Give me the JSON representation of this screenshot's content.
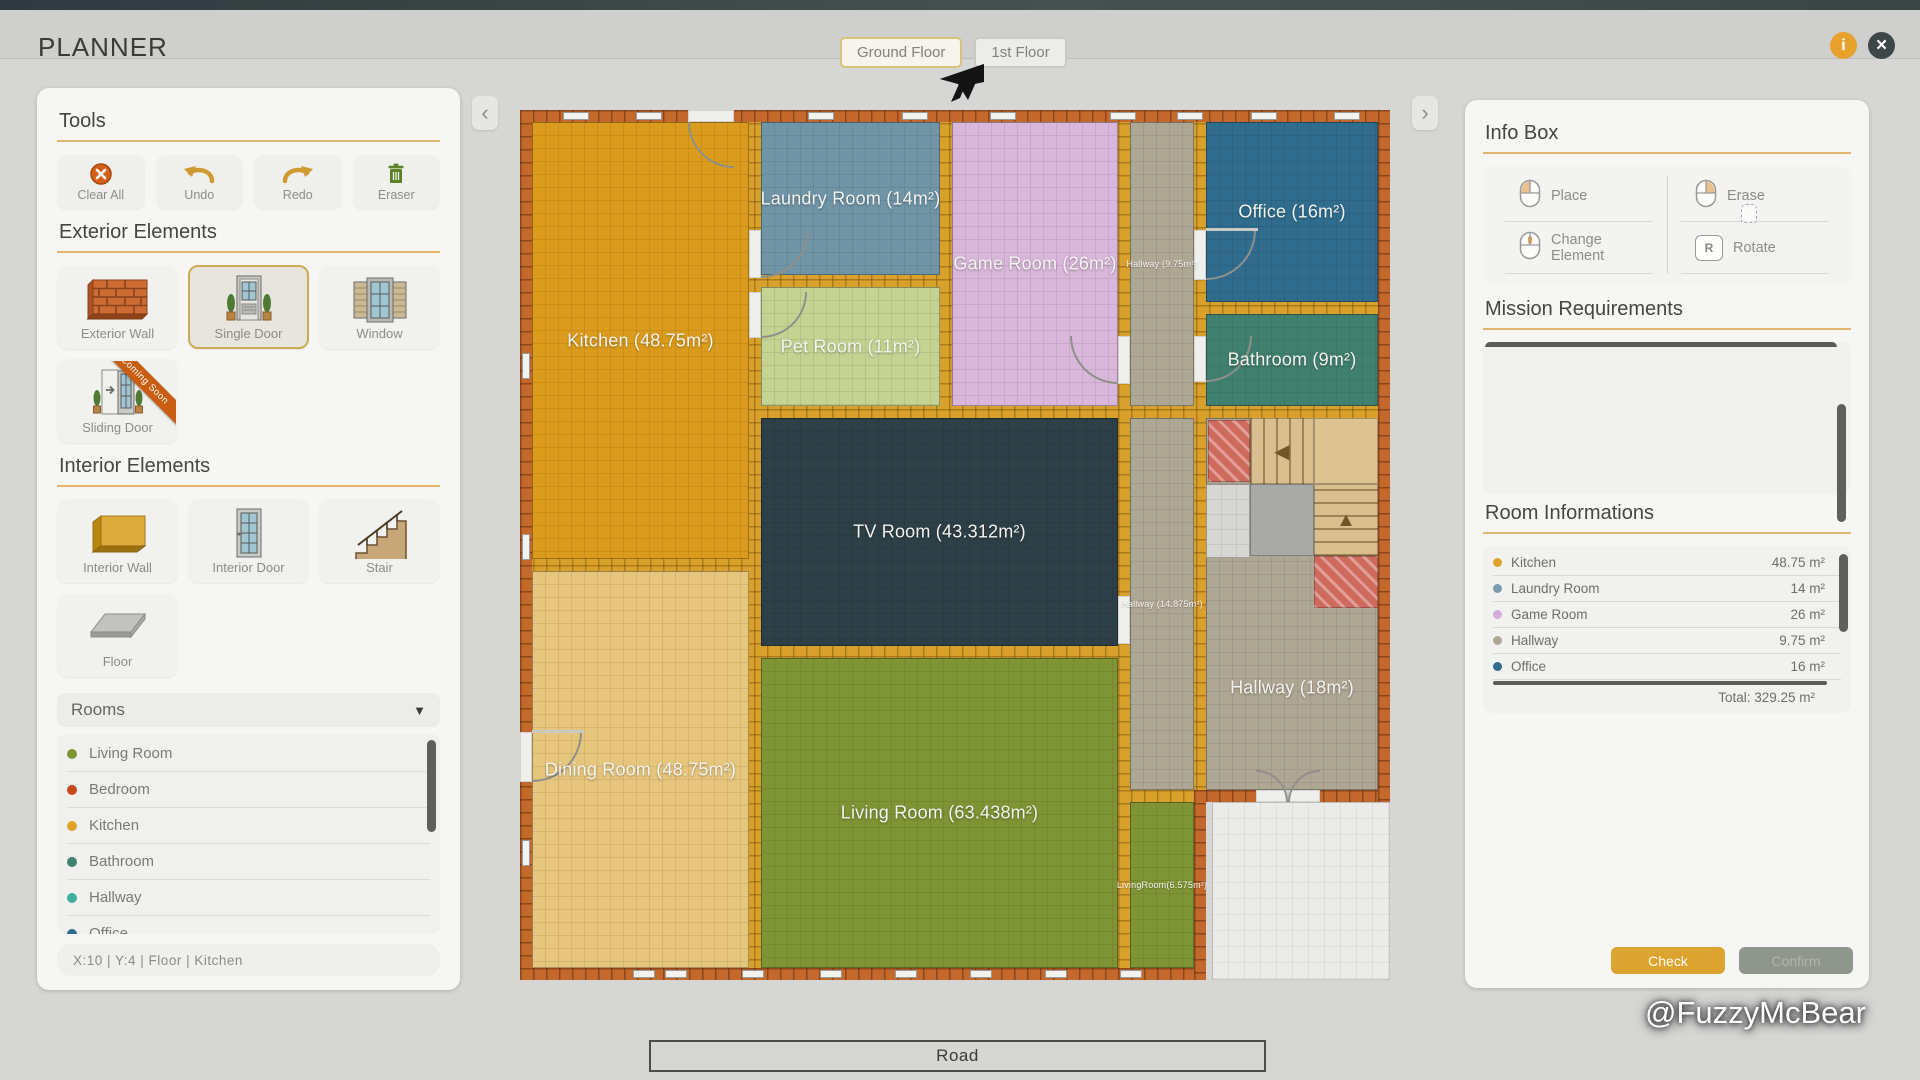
{
  "app": {
    "title": "PLANNER",
    "tabs": [
      "Ground Floor",
      "1st Floor"
    ],
    "active_tab": "Ground Floor"
  },
  "icons": {
    "info": "i",
    "close": "×",
    "collapse_left": "‹",
    "collapse_right": "›",
    "dropdown": "▼"
  },
  "left_panel": {
    "tools": {
      "heading": "Tools",
      "buttons": [
        {
          "label": "Clear All",
          "icon": "clear-all"
        },
        {
          "label": "Undo",
          "icon": "undo"
        },
        {
          "label": "Redo",
          "icon": "redo"
        },
        {
          "label": "Eraser",
          "icon": "eraser"
        }
      ]
    },
    "exterior": {
      "heading": "Exterior Elements",
      "items": [
        {
          "label": "Exterior Wall",
          "icon": "exterior-wall"
        },
        {
          "label": "Single Door",
          "icon": "single-door",
          "selected": true
        },
        {
          "label": "Window",
          "icon": "window"
        },
        {
          "label": "Sliding Door",
          "icon": "sliding-door",
          "ribbon": "Coming Soon"
        }
      ]
    },
    "interior": {
      "heading": "Interior Elements",
      "items": [
        {
          "label": "Interior Wall",
          "icon": "interior-wall"
        },
        {
          "label": "Interior Door",
          "icon": "interior-door"
        },
        {
          "label": "Stair",
          "icon": "stair"
        },
        {
          "label": "Floor",
          "icon": "floor"
        }
      ]
    },
    "rooms": {
      "heading": "Rooms",
      "items": [
        {
          "name": "Living Room",
          "color": "#7e9435"
        },
        {
          "name": "Bedroom",
          "color": "#c7481d"
        },
        {
          "name": "Kitchen",
          "color": "#dfa32b"
        },
        {
          "name": "Bathroom",
          "color": "#41806f"
        },
        {
          "name": "Hallway",
          "color": "#3fae9e"
        },
        {
          "name": "Office",
          "color": "#2f6c8e"
        }
      ]
    },
    "status": "X:10   |   Y:4   |   Floor   |   Kitchen"
  },
  "right_panel": {
    "info_box": {
      "heading": "Info Box",
      "actions": [
        {
          "label": "Place",
          "icon": "mouse-left"
        },
        {
          "label": "Erase",
          "icon": "mouse-right"
        },
        {
          "label": "Change Element",
          "icon": "mouse-middle"
        },
        {
          "label": "Rotate",
          "icon": "key",
          "key": "R"
        }
      ]
    },
    "mission": {
      "heading": "Mission Requirements"
    },
    "room_info": {
      "heading": "Room Informations",
      "rows": [
        {
          "name": "Kitchen",
          "area": "48.75 m²",
          "color": "#dfa32b"
        },
        {
          "name": "Laundry Room",
          "area": "14 m²",
          "color": "#7b9cb0"
        },
        {
          "name": "Game Room",
          "area": "26 m²",
          "color": "#d2aed6"
        },
        {
          "name": "Hallway",
          "area": "9.75 m²",
          "color": "#aea794"
        },
        {
          "name": "Office",
          "area": "16 m²",
          "color": "#2f6c8e"
        }
      ],
      "total": "Total: 329.25 m²"
    },
    "buttons": {
      "check": "Check",
      "confirm": "Confirm"
    }
  },
  "floorplan": {
    "road_label": "Road",
    "walls": [
      {
        "x": 0,
        "y": 0,
        "w": 870,
        "h": 692
      },
      {
        "x": 0,
        "y": 680,
        "w": 686,
        "h": 190
      }
    ],
    "rooms": [
      {
        "name": "kitchen",
        "label": "Kitchen (48.75m²)",
        "x": 12,
        "y": 12,
        "w": 217,
        "h": 437,
        "color": "#db9c1d"
      },
      {
        "name": "dining-room",
        "label": "Dining Room (48.75m²)",
        "x": 12,
        "y": 461,
        "w": 217,
        "h": 397,
        "color": "#e6c57d"
      },
      {
        "name": "laundry-room",
        "label": "Laundry Room (14m²)",
        "x": 241,
        "y": 12,
        "w": 179,
        "h": 153,
        "color": "#6f95a7"
      },
      {
        "name": "pet-room",
        "label": "Pet Room (11m²)",
        "x": 241,
        "y": 177,
        "w": 179,
        "h": 119,
        "color": "#c4d392"
      },
      {
        "name": "game-room",
        "label": "Game Room (26m²)",
        "x": 432,
        "y": 12,
        "w": 166,
        "h": 284,
        "color": "#d9b7da"
      },
      {
        "name": "hallway-top",
        "label": "Hallway (9.75m²)",
        "x": 610,
        "y": 12,
        "w": 64,
        "h": 284,
        "color": "#aea794",
        "small": true
      },
      {
        "name": "office",
        "label": "Office (16m²)",
        "x": 686,
        "y": 12,
        "w": 172,
        "h": 180,
        "color": "#2f6c8e"
      },
      {
        "name": "bathroom",
        "label": "Bathroom (9m²)",
        "x": 686,
        "y": 204,
        "w": 172,
        "h": 92,
        "color": "#41806f"
      },
      {
        "name": "tv-room",
        "label": "TV Room (43.312m²)",
        "x": 241,
        "y": 308,
        "w": 357,
        "h": 228,
        "color": "#2d3f47"
      },
      {
        "name": "hallway-mid",
        "label": "Hallway (14.875m²)",
        "x": 610,
        "y": 308,
        "w": 64,
        "h": 372,
        "color": "#aea794",
        "small": true
      },
      {
        "name": "hallway-main",
        "label": "Hallway (18m²)",
        "x": 686,
        "y": 308,
        "w": 172,
        "h": 372,
        "color": "#aea794",
        "labelDy": 84
      },
      {
        "name": "living-room",
        "label": "Living Room (63.438m²)",
        "x": 241,
        "y": 548,
        "w": 357,
        "h": 310,
        "color": "#7e9435"
      },
      {
        "name": "living-room-strip",
        "label": "LivingRoom(6.575m²)",
        "x": 610,
        "y": 692,
        "w": 64,
        "h": 166,
        "color": "#7e9435",
        "small": true
      },
      {
        "name": "outside-area",
        "x": 692,
        "y": 692,
        "w": 178,
        "h": 178,
        "color": "#ebebe9",
        "outside": true
      }
    ],
    "stairs": [
      {
        "kind": "hatch",
        "x": 688,
        "y": 310,
        "w": 42,
        "h": 62
      },
      {
        "kind": "steps-v",
        "x": 730,
        "y": 308,
        "w": 64,
        "h": 66,
        "arrow": "◀"
      },
      {
        "kind": "landing",
        "x": 794,
        "y": 308,
        "w": 64,
        "h": 66
      },
      {
        "kind": "tiles",
        "x": 686,
        "y": 374,
        "w": 44,
        "h": 74
      },
      {
        "kind": "pad",
        "x": 730,
        "y": 374,
        "w": 64,
        "h": 72
      },
      {
        "kind": "steps-h",
        "x": 794,
        "y": 374,
        "w": 64,
        "h": 72,
        "arrow": "▲"
      },
      {
        "kind": "hatch",
        "x": 794,
        "y": 446,
        "w": 64,
        "h": 52
      }
    ],
    "bricks": [
      {
        "x": 0,
        "y": 0,
        "w": 870,
        "h": 12
      },
      {
        "x": 0,
        "y": 0,
        "w": 12,
        "h": 870
      },
      {
        "x": 858,
        "y": 0,
        "w": 12,
        "h": 692
      },
      {
        "x": 0,
        "y": 858,
        "w": 686,
        "h": 12
      },
      {
        "x": 674,
        "y": 680,
        "w": 12,
        "h": 190
      },
      {
        "x": 686,
        "y": 680,
        "w": 172,
        "h": 12
      }
    ],
    "windows": [
      [
        43,
        2,
        26,
        8
      ],
      [
        116,
        2,
        26,
        8
      ],
      [
        288,
        2,
        26,
        8
      ],
      [
        382,
        2,
        26,
        8
      ],
      [
        470,
        2,
        26,
        8
      ],
      [
        590,
        2,
        26,
        8
      ],
      [
        657,
        2,
        26,
        8
      ],
      [
        731,
        2,
        26,
        8
      ],
      [
        814,
        2,
        26,
        8
      ],
      [
        2,
        243,
        8,
        26
      ],
      [
        2,
        424,
        8,
        26
      ],
      [
        2,
        730,
        8,
        26
      ],
      [
        113,
        860,
        22,
        8
      ],
      [
        145,
        860,
        22,
        8
      ],
      [
        222,
        860,
        22,
        8
      ],
      [
        300,
        860,
        22,
        8
      ],
      [
        375,
        860,
        22,
        8
      ],
      [
        450,
        860,
        22,
        8
      ],
      [
        525,
        860,
        22,
        8
      ],
      [
        600,
        860,
        22,
        8
      ]
    ],
    "doors": [
      {
        "gap": [
          168,
          0,
          46,
          12
        ],
        "arc": [
          168,
          12,
          46,
          "bl"
        ]
      },
      {
        "gap": [
          229,
          120,
          12,
          48
        ],
        "arc": [
          241,
          120,
          48,
          "br"
        ]
      },
      {
        "gap": [
          229,
          182,
          12,
          46
        ],
        "arc": [
          241,
          182,
          46,
          "br"
        ]
      },
      {
        "gap": [
          598,
          226,
          12,
          48
        ],
        "arc": [
          550,
          226,
          48,
          "bl"
        ]
      },
      {
        "gap": [
          674,
          120,
          12,
          50
        ],
        "arc": [
          686,
          120,
          50,
          "br"
        ],
        "line": [
          686,
          118,
          52,
          3
        ]
      },
      {
        "gap": [
          674,
          226,
          12,
          46
        ],
        "arc": [
          686,
          226,
          46,
          "br"
        ]
      },
      {
        "gap": [
          598,
          486,
          12,
          48
        ]
      },
      {
        "gap": [
          0,
          622,
          12,
          50
        ],
        "arc": [
          12,
          622,
          50,
          "br"
        ],
        "line": [
          12,
          620,
          52,
          3
        ]
      },
      {
        "gap": [
          736,
          680,
          32,
          12
        ],
        "arc": [
          736,
          660,
          32,
          "tr"
        ]
      },
      {
        "gap": [
          768,
          680,
          32,
          12
        ],
        "arc": [
          768,
          660,
          32,
          "tl"
        ]
      }
    ]
  },
  "watermark": "@FuzzyMcBear"
}
